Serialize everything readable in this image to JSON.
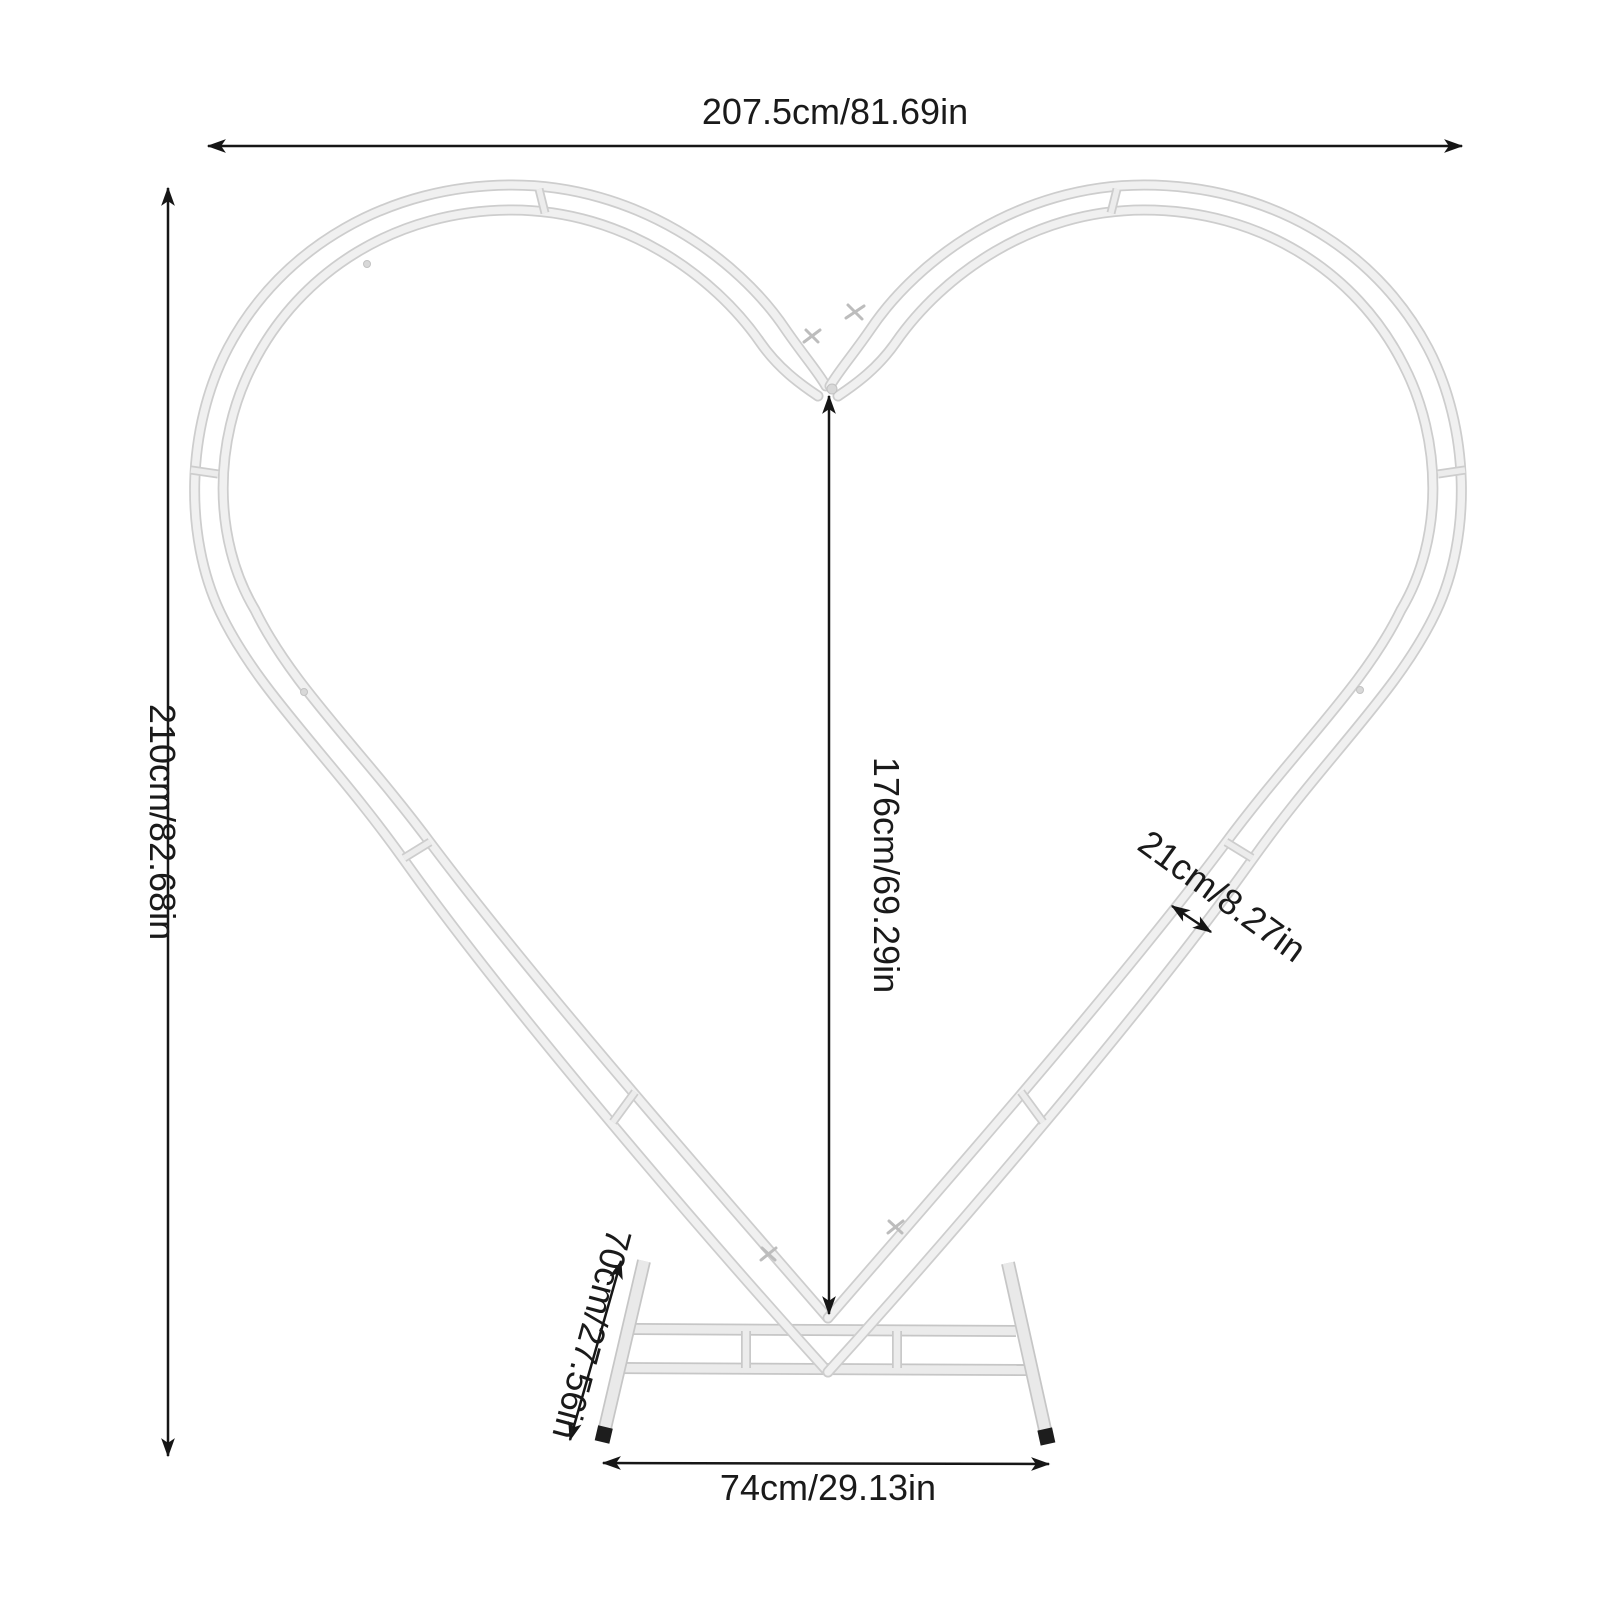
{
  "diagram": {
    "title": "heart-shaped-arch-backdrop-stand-dimensions",
    "labels": {
      "total_width": "207.5cm/81.69in",
      "total_height": "210cm/82.68in",
      "center_height": "176cm/69.29in",
      "frame_gap": "21cm/8.27in",
      "base_depth": "70cm/27.56in",
      "base_width": "74cm/29.13in"
    },
    "colors": {
      "background": "#ffffff",
      "frame_fill": "#f0f0f0",
      "frame_edge": "#cdcdcd",
      "dimension_line": "#161616",
      "text": "#1a1a1a",
      "foot_cap": "#1d1d1d"
    }
  }
}
